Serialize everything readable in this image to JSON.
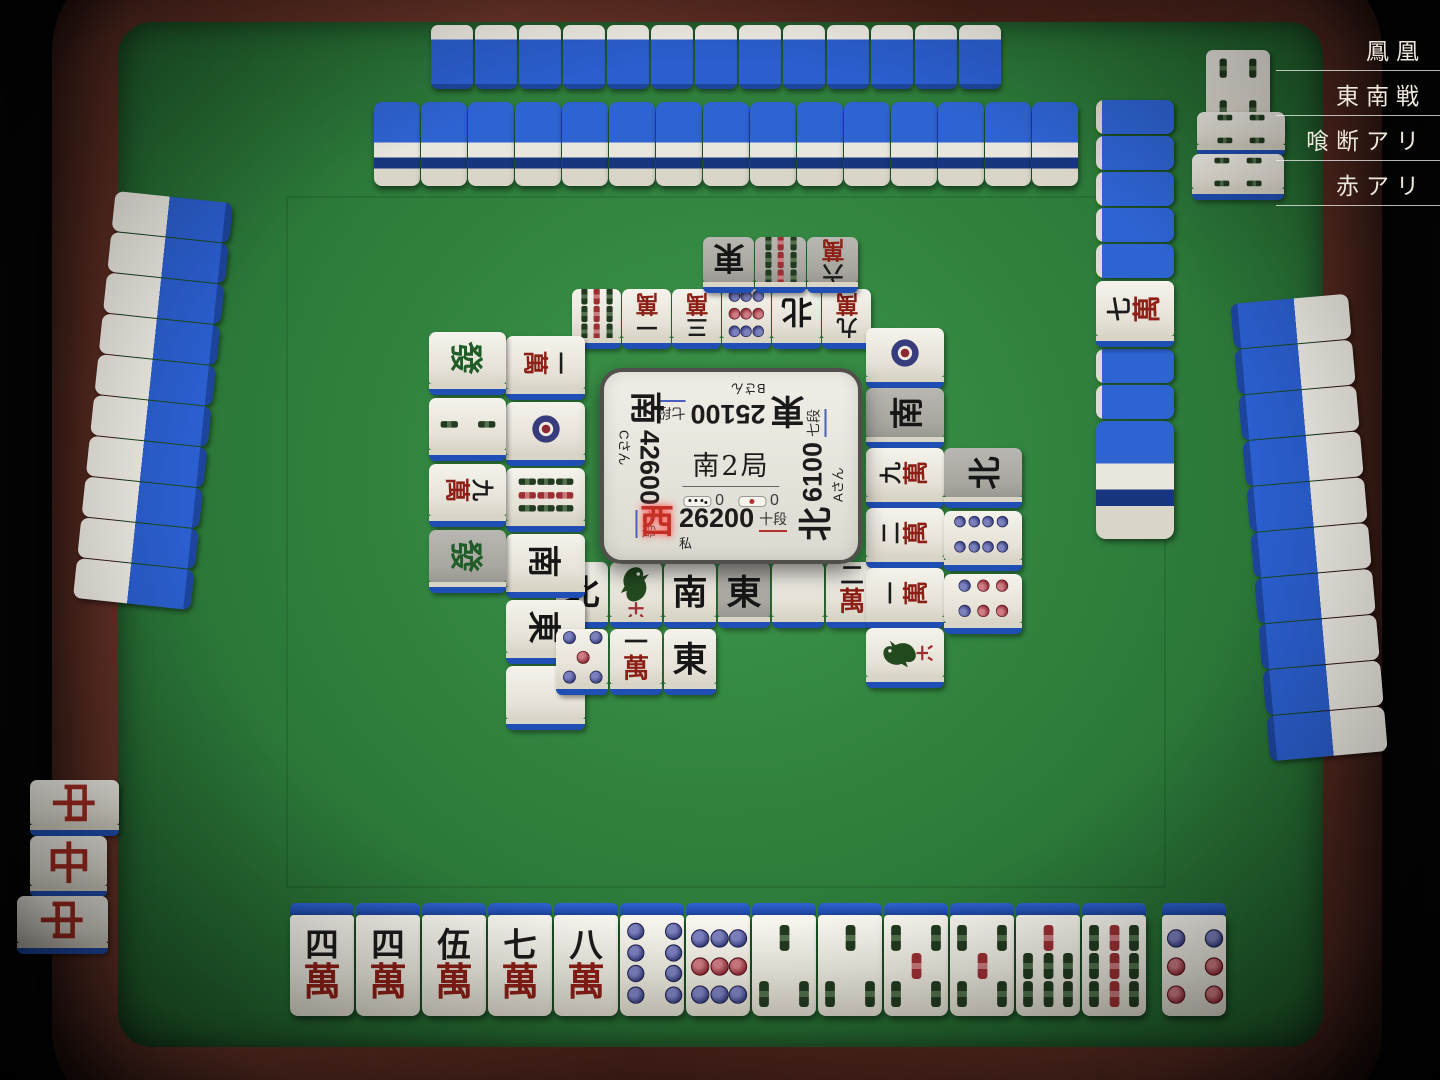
{
  "nav": {
    "items": [
      "鳳凰",
      "東南戦",
      "喰断アリ",
      "赤アリ"
    ]
  },
  "center": {
    "round": "南2局",
    "honba_count": "0",
    "riichi_stick_count": "0",
    "players": {
      "top": {
        "wind": "東",
        "score": "25100",
        "rank": "七段",
        "name": "Bさん",
        "rank_color": "blue",
        "active": false
      },
      "left": {
        "wind": "南",
        "score": "42600",
        "rank": "七段",
        "name": "Cさん",
        "rank_color": "blue",
        "active": false
      },
      "right": {
        "wind": "北",
        "score": "6100",
        "rank": "七段",
        "name": "Aさん",
        "rank_color": "blue",
        "active": false
      },
      "bottom": {
        "wind": "西",
        "score": "26200",
        "rank": "十段",
        "name": "私",
        "rank_color": "red",
        "active": true
      }
    }
  },
  "hand": {
    "tiles": [
      "m4",
      "m4",
      "m5",
      "m7",
      "m8",
      "p8",
      "p9",
      "s3",
      "s3",
      "s5",
      "s5",
      "s7",
      "s9"
    ],
    "drawn": "p6"
  },
  "discards": {
    "bottom": {
      "row1": [
        {
          "t": "N"
        },
        {
          "t": "s1"
        },
        {
          "t": "S"
        },
        {
          "t": "E",
          "g": 1
        },
        {
          "t": "haku"
        },
        {
          "t": "m2"
        }
      ],
      "row2": [
        {
          "t": "p5"
        },
        {
          "t": "m1"
        },
        {
          "t": "E"
        }
      ]
    },
    "top": {
      "row1": [
        {
          "t": "s9"
        },
        {
          "t": "m1"
        },
        {
          "t": "m3"
        },
        {
          "t": "p9"
        },
        {
          "t": "N"
        },
        {
          "t": "m9"
        }
      ],
      "row2": [
        {
          "t": "E",
          "g": 1
        },
        {
          "t": "s9",
          "g": 1
        },
        {
          "t": "m6",
          "g": 1
        }
      ]
    },
    "left": {
      "row1": [
        {
          "t": "m1"
        },
        {
          "t": "p1"
        },
        {
          "t": "s9"
        },
        {
          "t": "S"
        },
        {
          "t": "E"
        },
        {
          "t": "haku"
        }
      ],
      "row2": [
        {
          "t": "hatsu"
        },
        {
          "t": "s2"
        },
        {
          "t": "m9"
        },
        {
          "t": "hatsu",
          "g": 1
        }
      ]
    },
    "right": {
      "row1": [
        {
          "t": "p1"
        },
        {
          "t": "S",
          "g": 1
        },
        {
          "t": "m9"
        },
        {
          "t": "m2"
        },
        {
          "t": "m1"
        },
        {
          "t": "s1"
        }
      ],
      "row2": [
        {
          "t": "N",
          "g": 1
        },
        {
          "t": "p8"
        },
        {
          "t": "p6"
        }
      ]
    }
  },
  "melds": {
    "left_player": {
      "type": "pon",
      "tile": "chun",
      "tiles": [
        {
          "t": "chun",
          "rot": 90
        },
        {
          "t": "chun",
          "rot": 0
        },
        {
          "t": "chun",
          "rot": 90
        }
      ]
    },
    "right_player": {
      "type": "pon",
      "tile": "s4",
      "tiles": [
        {
          "t": "s4",
          "rot": 0
        },
        {
          "t": "s4",
          "rot": 90
        },
        {
          "t": "s4",
          "rot": 90
        }
      ]
    }
  },
  "walls": {
    "top_stacks": 15,
    "dead_wall": {
      "backs_before_dora": 5,
      "dora_indicator": "m7",
      "backs_after_dora": 2,
      "end_double_stack": true
    }
  },
  "opponents": {
    "top_hand_count": 13,
    "left_hand_count": 10,
    "right_hand_count": 10
  },
  "colors": {
    "tile_back": "#2b5fd0",
    "felt": "#31833f",
    "man_red": "#8c1f16",
    "rank_blue_underline": "#4a5fc0",
    "rank_red_underline": "#b03030",
    "active_wind": "#c23024"
  }
}
